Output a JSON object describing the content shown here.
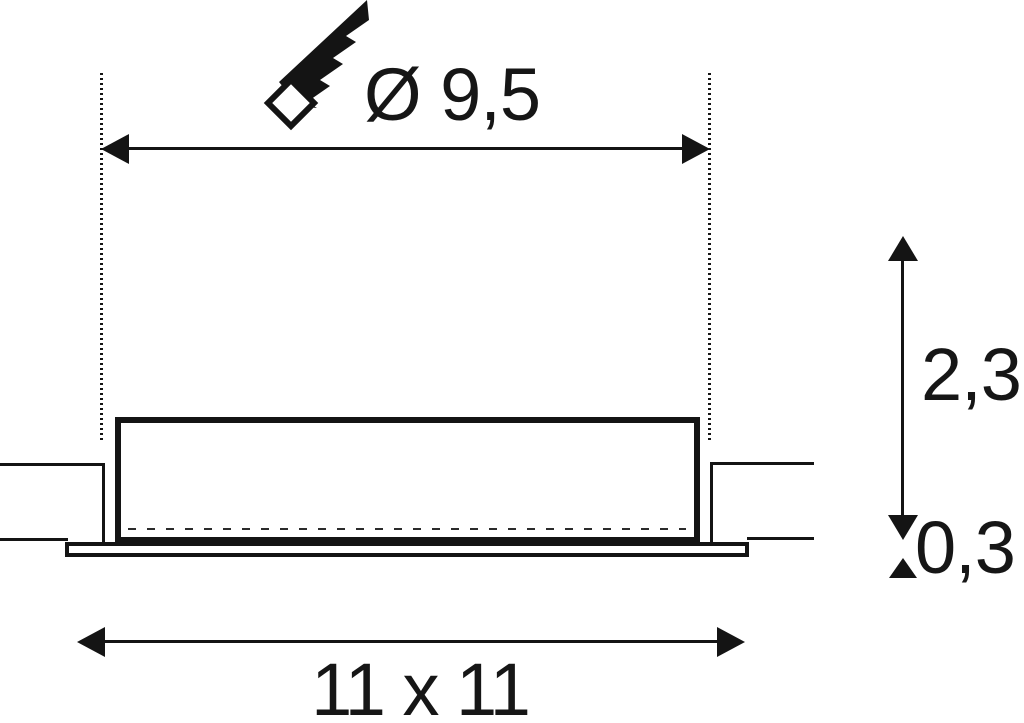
{
  "drawing": {
    "labels": {
      "cutout_diameter": "Ø 9,5",
      "recess_depth": "2,3",
      "flange_thickness": "0,3",
      "fixture_dimensions": "11 x 11"
    },
    "icons": [
      {
        "name": "hole-saw-icon"
      }
    ],
    "colors": {
      "line": "#141414",
      "background": "#ffffff"
    }
  }
}
